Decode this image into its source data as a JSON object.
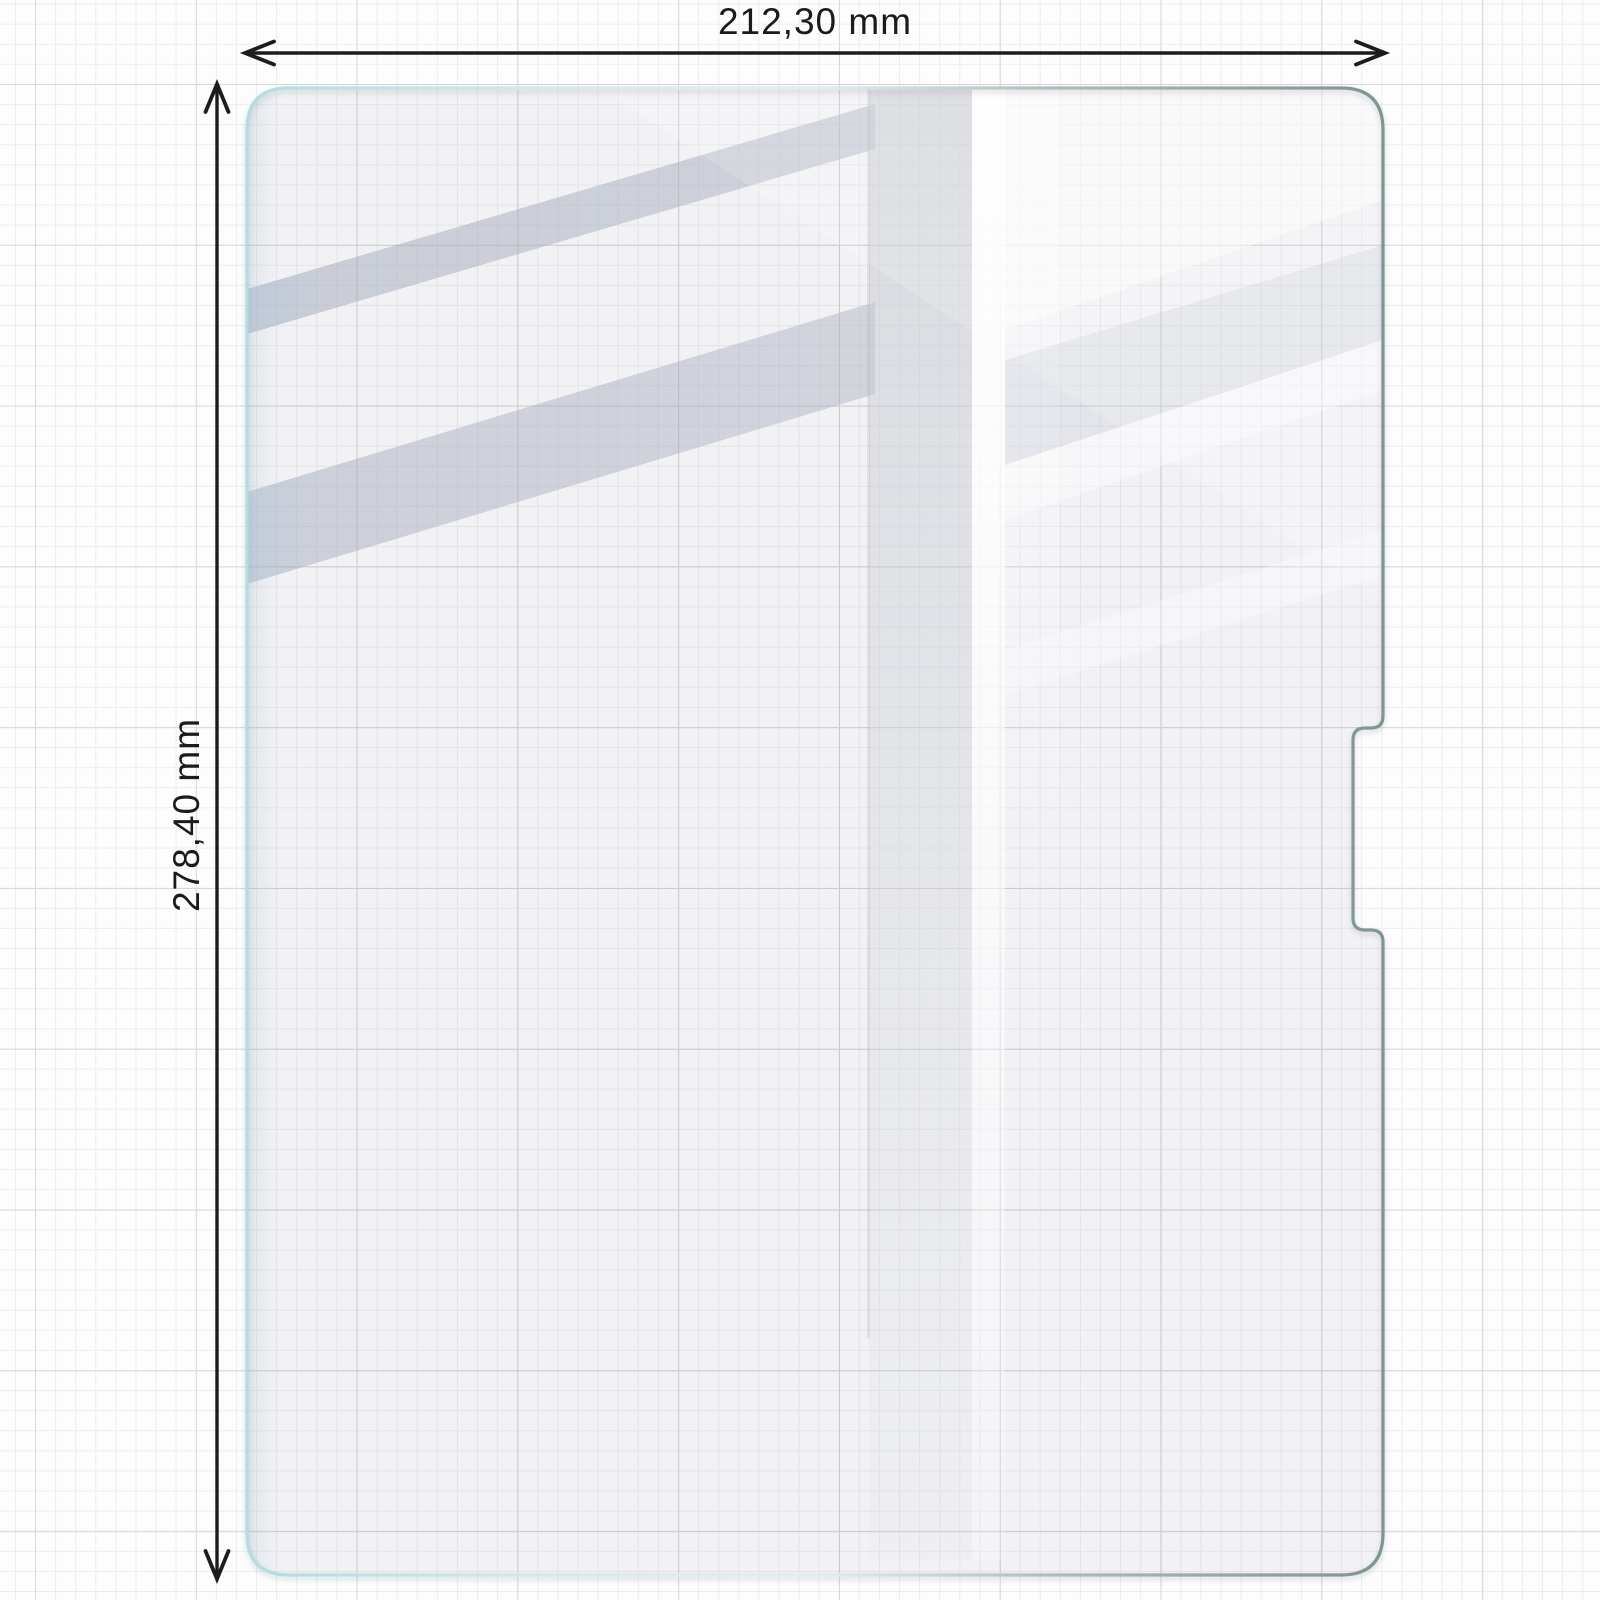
{
  "diagram": {
    "width_dimension": {
      "label": "212,30 mm",
      "value": "212,30",
      "unit": "mm"
    },
    "height_dimension": {
      "label": "278,40 mm",
      "value": "278,40",
      "unit": "mm"
    }
  },
  "colors": {
    "background": "#fdfdfd",
    "grid_minor": "#ededef",
    "grid_major": "#d8d8da",
    "dimension_lines": "#1c1c1c",
    "glass_fill": "#f2f2f5",
    "glass_edge_cyan": "#aedede",
    "glass_edge_slate": "#7f9593",
    "reflection_gray": "#acb2c0"
  }
}
